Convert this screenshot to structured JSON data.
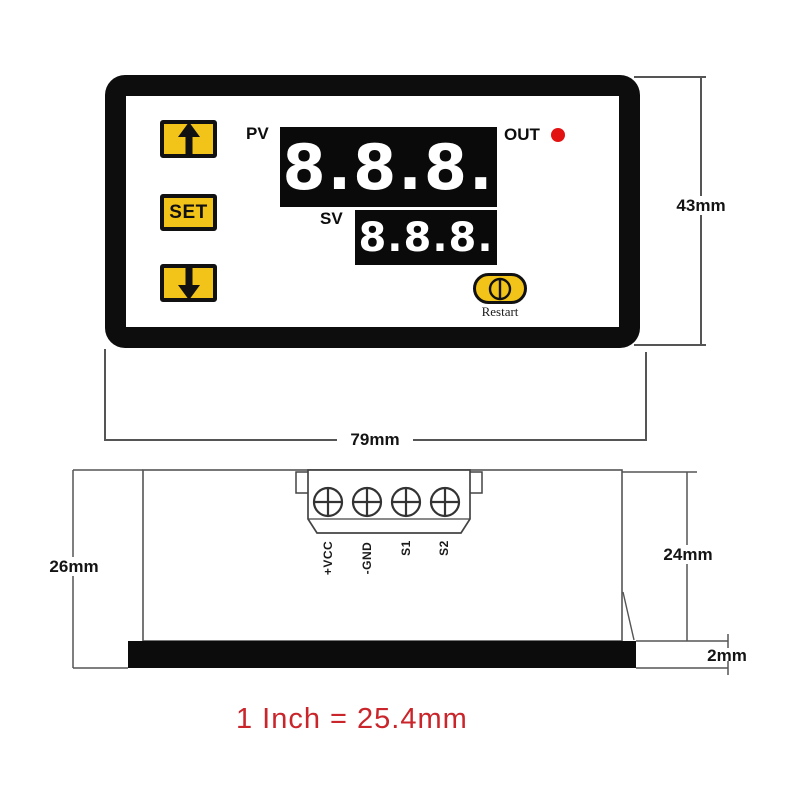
{
  "front_view": {
    "pv_label": "PV",
    "sv_label": "SV",
    "out_label": "OUT",
    "pv_value": "8.8.8.",
    "sv_value": "8.8.8.",
    "set_button_label": "SET",
    "up_button_icon": "arrow-up",
    "down_button_icon": "arrow-down",
    "restart_button_icon": "power-reset",
    "restart_label": "Restart",
    "height_dimension": "43mm",
    "width_dimension": "79mm"
  },
  "side_view": {
    "terminals": [
      "+VCC",
      "-GND",
      "S1",
      "S2"
    ],
    "terminal_screw_icon": "screw-head",
    "total_height_dimension": "26mm",
    "body_depth_dimension": "24mm",
    "bezel_thickness_dimension": "2mm"
  },
  "note": {
    "scale_text": "1 Inch = 25.4mm"
  },
  "colors": {
    "button_yellow": "#F2C318",
    "led_red": "#E31212",
    "note_red": "#C9252B",
    "display_background": "#0A0A0A",
    "display_digits": "#FFFFFF",
    "frame_black": "#0D0D0D",
    "line_gray": "#555555"
  }
}
